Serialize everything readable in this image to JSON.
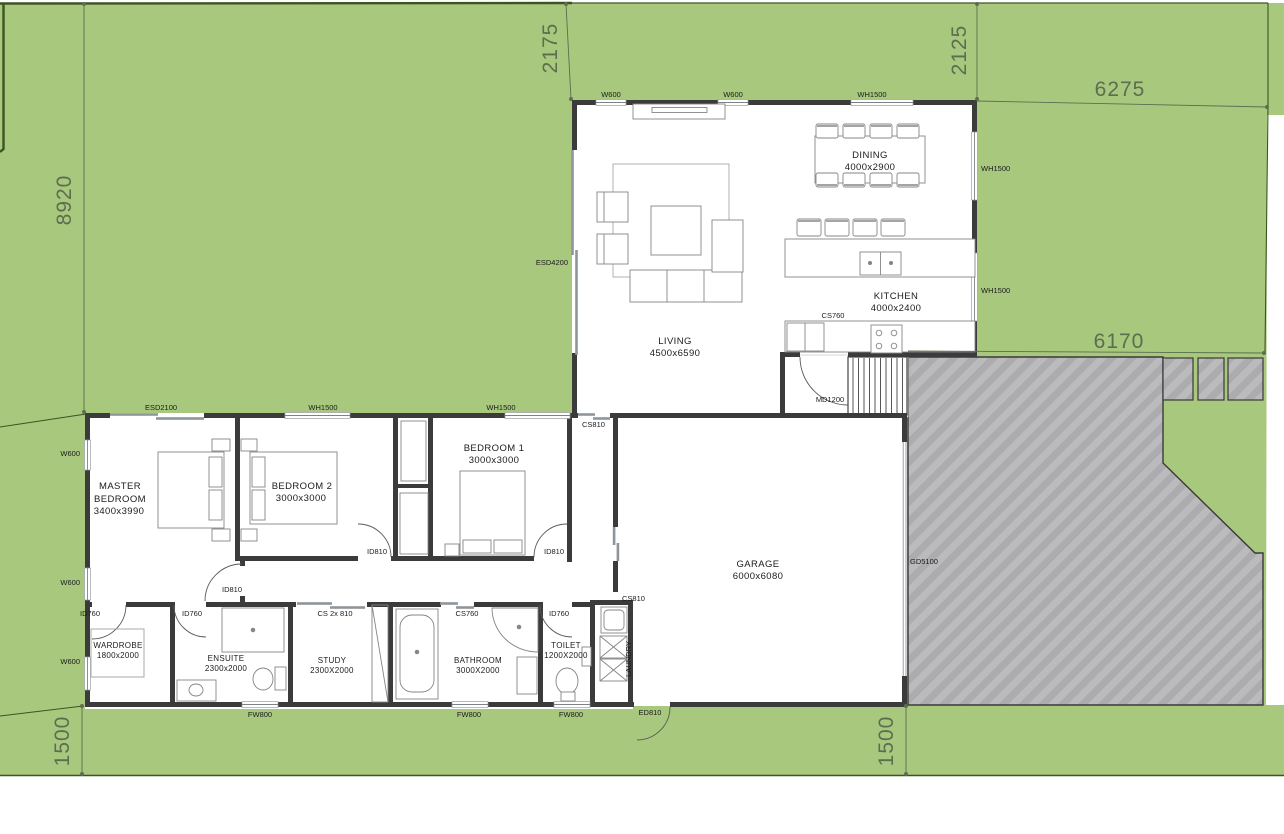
{
  "title": "Residential floor plan site drawing",
  "colors": {
    "lot_green": "#a8c87e",
    "boundary_green": "#3c5420",
    "dimension_green": "#5c6e4f",
    "wall_dark": "#3b3b3b",
    "driveway_gray": "#bbbbbd",
    "hatch_gray": "#acacaf",
    "paper_white": "#ffffff"
  },
  "dimensions": {
    "west_8920": "8920",
    "north_2175": "2175",
    "north_2125": "2125",
    "east_6275": "6275",
    "east_6170": "6170",
    "south_left_1500": "1500",
    "south_right_1500": "1500"
  },
  "rooms": {
    "living": {
      "name": "LIVING",
      "size": "4500x6590"
    },
    "dining": {
      "name": "DINING",
      "size": "4000x2900"
    },
    "kitchen": {
      "name": "KITCHEN",
      "size": "4000x2400"
    },
    "master": {
      "line1": "MASTER",
      "line2": "BEDROOM",
      "size": "3400x3990"
    },
    "bedroom2": {
      "name": "BEDROOM 2",
      "size": "3000x3000"
    },
    "bedroom1": {
      "name": "BEDROOM 1",
      "size": "3000x3000"
    },
    "garage": {
      "name": "GARAGE",
      "size": "6000x6080"
    },
    "wardrobe": {
      "name": "WARDROBE",
      "size": "1800x2000"
    },
    "ensuite": {
      "name": "ENSUITE",
      "size": "2300x2000"
    },
    "study": {
      "name": "STUDY",
      "size": "2300X2000"
    },
    "bathroom": {
      "name": "BATHROOM",
      "size": "3000X2000"
    },
    "toilet": {
      "name": "TOILET",
      "size": "1200X2000"
    },
    "laundry": {
      "name": "LAUNDRY"
    }
  },
  "openings": {
    "top_w600_a": "W600",
    "top_w600_b": "W600",
    "top_wh1500": "WH1500",
    "east_wh1500_a": "WH1500",
    "east_wh1500_b": "WH1500",
    "living_esd4200": "ESD4200",
    "kitchen_cs760": "CS760",
    "kitchen_md1200": "MD1200",
    "bed_esd2100": "ESD2100",
    "bed2_wh1500": "WH1500",
    "bed1_wh1500": "WH1500",
    "west_w600_a": "W600",
    "west_w600_b": "W600",
    "west_w600_c": "W600",
    "hall_cs810": "CS810",
    "garage_cs810": "CS810",
    "master_id810": "ID810",
    "bed2_id810": "ID810",
    "bed1_id810": "ID810",
    "wardrobe_id760": "ID760",
    "ensuite_id760": "ID760",
    "toilet_id760": "ID760",
    "study_cs2x810": "CS 2x 810",
    "bathroom_cs760": "CS760",
    "fw800_a": "FW800",
    "fw800_b": "FW800",
    "fw800_c": "FW800",
    "entry_ed810": "ED810",
    "garage_gd5100": "GD5100"
  }
}
